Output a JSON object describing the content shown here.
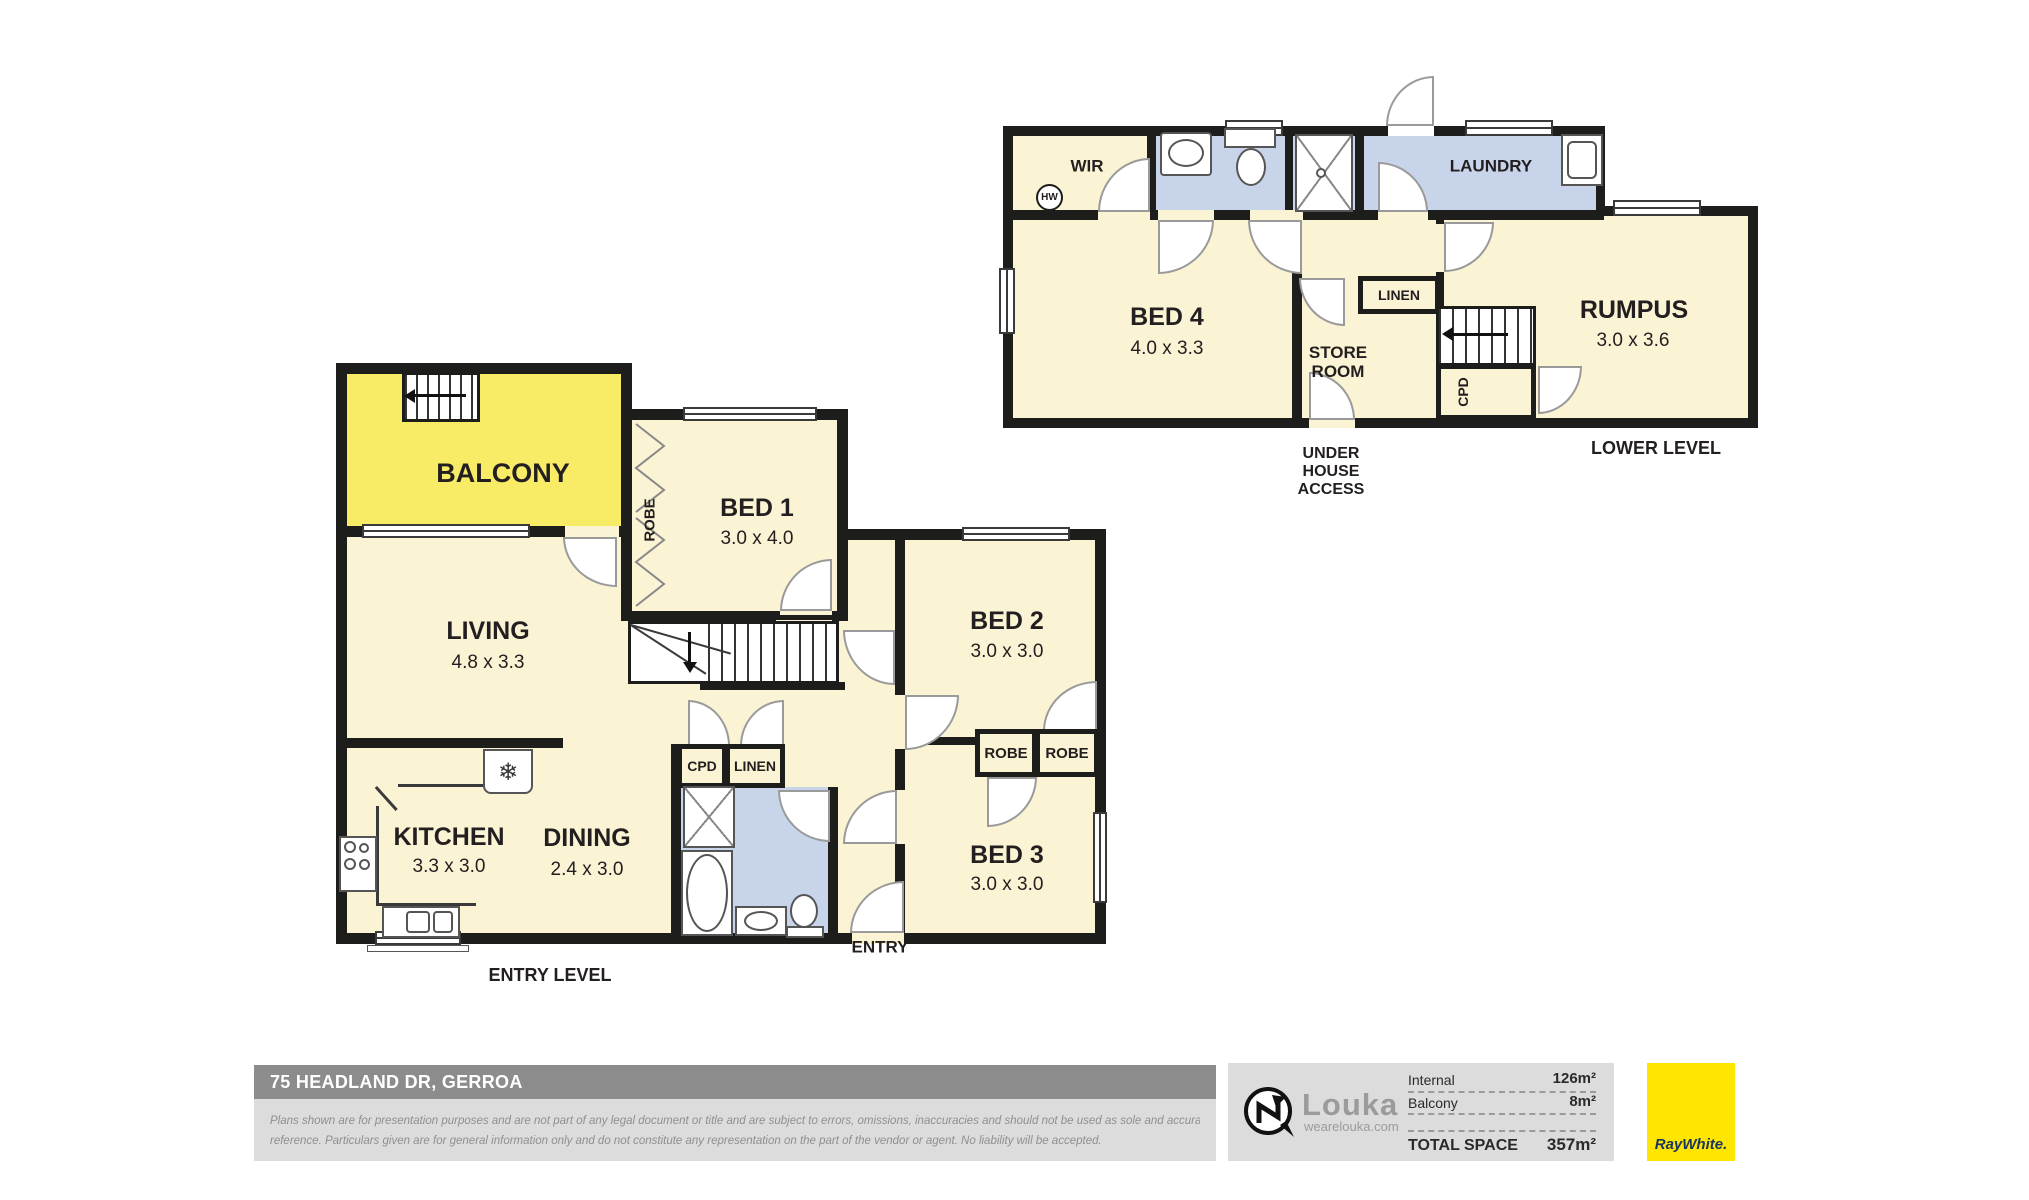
{
  "palette": {
    "room_fill": "#faf3d4",
    "wet_fill": "#c7d4ea",
    "balcony_fill": "#f8ec66",
    "wall": "#1d1d1b",
    "door_stroke": "#9a9a9a",
    "text": "#231f20",
    "footer_bar": "#8c8c8c",
    "panel": "#dcdcdc",
    "muted_text": "#8f8f8f",
    "brand_yellow": "#ffe600",
    "brand_navy": "#17345e"
  },
  "lower": {
    "caption": "LOWER LEVEL",
    "under_house_access": "UNDER HOUSE ACCESS",
    "hw": "HW",
    "rooms": {
      "wir": {
        "label": "WIR"
      },
      "laundry": {
        "label": "LAUNDRY"
      },
      "bed4": {
        "label": "BED 4",
        "dims": "4.0 x 3.3"
      },
      "store_room": {
        "label": "STORE ROOM"
      },
      "linen": {
        "label": "LINEN"
      },
      "cpd": {
        "label": "CPD"
      },
      "rumpus": {
        "label": "RUMPUS",
        "dims": "3.0 x 3.6"
      }
    }
  },
  "entry": {
    "caption": "ENTRY LEVEL",
    "entry_label": "ENTRY",
    "rooms": {
      "balcony": {
        "label": "BALCONY"
      },
      "bed1": {
        "label": "BED 1",
        "dims": "3.0 x 4.0"
      },
      "bed1_robe": {
        "label": "ROBE"
      },
      "living": {
        "label": "LIVING",
        "dims": "4.8 x 3.3"
      },
      "store": {
        "label": "STORE"
      },
      "bed2": {
        "label": "BED 2",
        "dims": "3.0 x 3.0"
      },
      "bed2_robe": {
        "label": "ROBE"
      },
      "bed3_robe": {
        "label": "ROBE"
      },
      "bed3": {
        "label": "BED 3",
        "dims": "3.0 x 3.0"
      },
      "kitchen": {
        "label": "KITCHEN",
        "dims": "3.3 x 3.0"
      },
      "dining": {
        "label": "DINING",
        "dims": "2.4 x 3.0"
      },
      "cpd": {
        "label": "CPD"
      },
      "linen": {
        "label": "LINEN"
      }
    },
    "icons": {
      "fridge_snowflake": "❄"
    }
  },
  "footer": {
    "address": "75 HEADLAND DR, GERROA",
    "disclaimer_line1": "Plans shown are for presentation purposes and are not part of any legal document or title and are subject to errors, omissions, inaccuracies and should not be used as sole and accurate",
    "disclaimer_line2": "reference. Particulars given are for general information only and do not constitute any representation on the part of the vendor or agent. No liability will be accepted.",
    "louka": {
      "name": "Louka",
      "url": "wearelouka.com"
    },
    "areas": {
      "internal_label": "Internal",
      "internal_value": "126m²",
      "balcony_label": "Balcony",
      "balcony_value": "8m²",
      "total_label": "TOTAL SPACE",
      "total_value": "357m²"
    },
    "brand": "RayWhite."
  }
}
